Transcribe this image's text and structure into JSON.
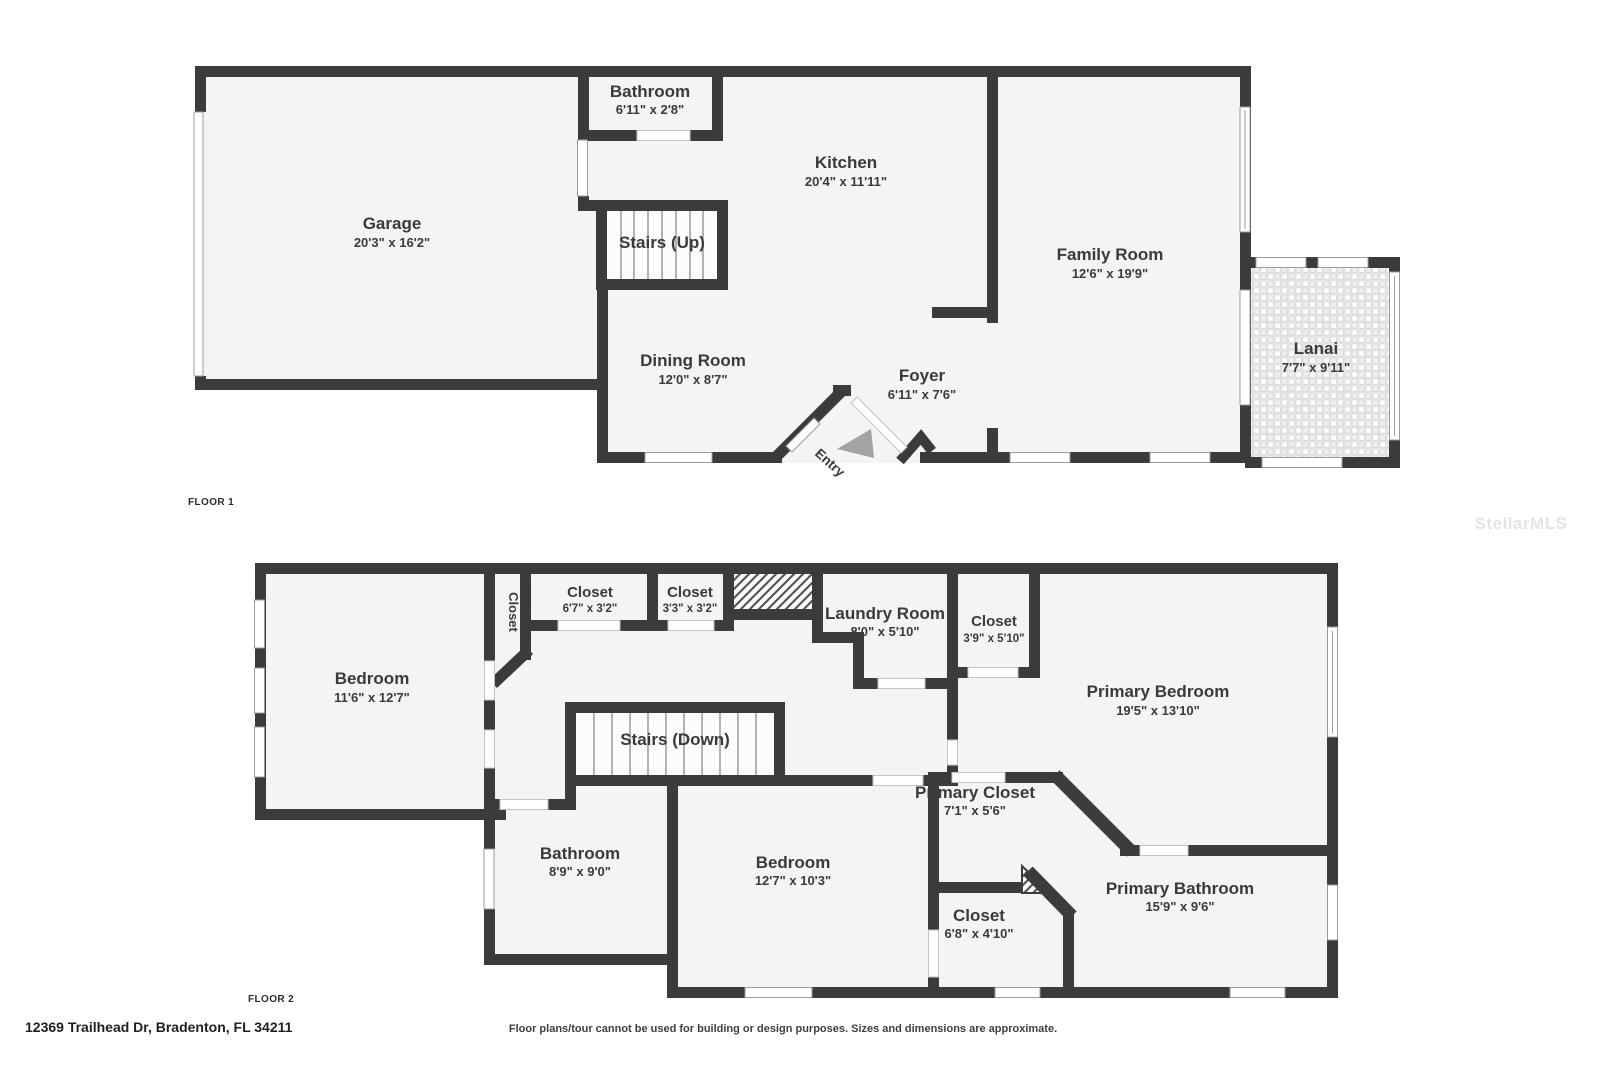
{
  "watermark": "StellarMLS",
  "footer": {
    "address": "12369 Trailhead Dr, Bradenton, FL 34211",
    "disclaimer": "Floor plans/tour cannot be used for building or design purposes. Sizes and dimensions are approximate."
  },
  "colors": {
    "wall": "#3b3b3d",
    "floor": "#f4f4f5",
    "door_window": "#ffffff",
    "hatch": "#555555",
    "entry_arrow": "#a3a3a3",
    "text": "#3a3a3a",
    "watermark": "#e4e4e4"
  },
  "floor1": {
    "label": "FLOOR 1",
    "rooms": {
      "garage": {
        "name": "Garage",
        "dims": "20'3\" x 16'2\""
      },
      "bathroom": {
        "name": "Bathroom",
        "dims": "6'11\" x 2'8\""
      },
      "kitchen": {
        "name": "Kitchen",
        "dims": "20'4\" x 11'11\""
      },
      "stairs_up": {
        "name": "Stairs (Up)"
      },
      "family_room": {
        "name": "Family Room",
        "dims": "12'6\" x 19'9\""
      },
      "dining_room": {
        "name": "Dining Room",
        "dims": "12'0\" x 8'7\""
      },
      "foyer": {
        "name": "Foyer",
        "dims": "6'11\" x 7'6\""
      },
      "entry": {
        "name": "Entry"
      },
      "lanai": {
        "name": "Lanai",
        "dims": "7'7\" x 9'11\""
      }
    }
  },
  "floor2": {
    "label": "FLOOR 2",
    "rooms": {
      "bedroom_left": {
        "name": "Bedroom",
        "dims": "11'6\" x 12'7\""
      },
      "closet_hall": {
        "name": "Closet",
        "dims": "2'4\" x 4'5\""
      },
      "closet_a": {
        "name": "Closet",
        "dims": "6'7\" x 3'2\""
      },
      "closet_b": {
        "name": "Closet",
        "dims": "3'3\" x 3'2\""
      },
      "laundry": {
        "name": "Laundry Room",
        "dims": "8'0\" x 5'10\""
      },
      "closet_c": {
        "name": "Closet",
        "dims": "3'9\" x 5'10\""
      },
      "primary_bedroom": {
        "name": "Primary Bedroom",
        "dims": "19'5\" x 13'10\""
      },
      "stairs_down": {
        "name": "Stairs (Down)"
      },
      "bathroom": {
        "name": "Bathroom",
        "dims": "8'9\" x 9'0\""
      },
      "bedroom_mid": {
        "name": "Bedroom",
        "dims": "12'7\" x 10'3\""
      },
      "primary_closet": {
        "name": "Primary Closet",
        "dims": "7'1\" x 5'6\""
      },
      "closet_d": {
        "name": "Closet",
        "dims": "6'8\" x 4'10\""
      },
      "primary_bathroom": {
        "name": "Primary Bathroom",
        "dims": "15'9\" x 9'6\""
      }
    }
  }
}
